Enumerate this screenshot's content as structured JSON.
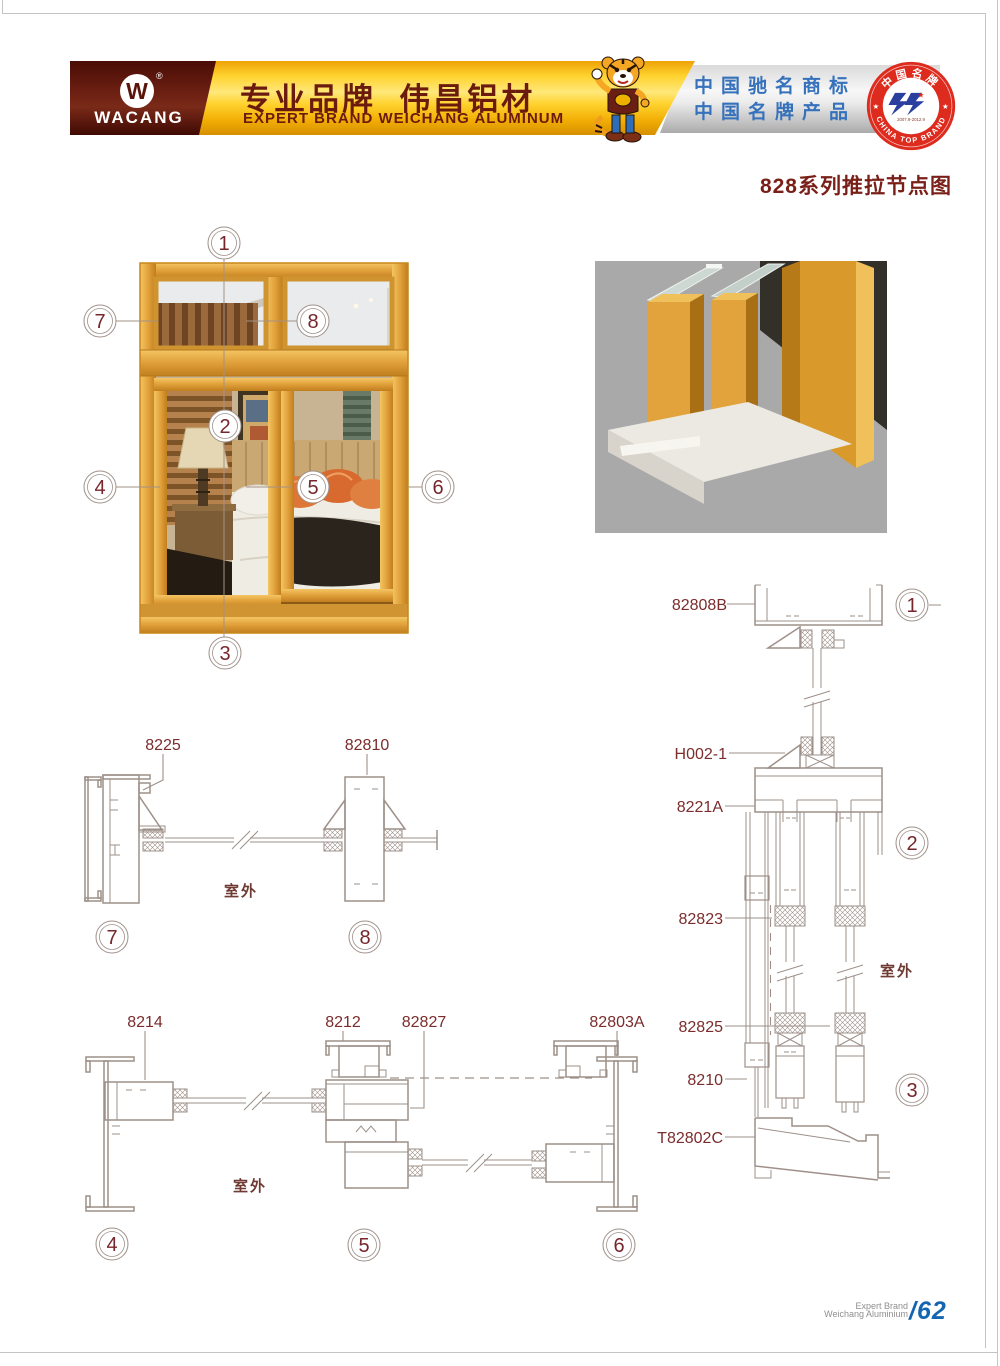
{
  "header": {
    "logo": {
      "brand": "WACANG",
      "registered": "®"
    },
    "slogan_cn": "专业品牌  伟昌铝材",
    "slogan_en": "EXPERT BRAND WEICHANG ALUMINUM",
    "awards": {
      "line1": "中国驰名商标",
      "line2": "中国名牌产品"
    },
    "seal": {
      "arc_top": "中国名牌",
      "arc_bottom": "CHINA TOP BRAND",
      "years": "2007.9-2012.9"
    }
  },
  "title": "828系列推拉节点图",
  "window_figure": {
    "callouts": {
      "c1": "1",
      "c2": "2",
      "c3": "3",
      "c4": "4",
      "c5": "5",
      "c6": "6",
      "c7": "7",
      "c8": "8"
    }
  },
  "details": {
    "outdoor_label": "室外",
    "top_section": {
      "labels": {
        "l8225": "8225",
        "l82810": "82810"
      },
      "callouts": {
        "c7": "7",
        "c8": "8"
      }
    },
    "bottom_section": {
      "labels": {
        "l8214": "8214",
        "l8212": "8212",
        "l82827": "82827",
        "l82803a": "82803A"
      },
      "callouts": {
        "c4": "4",
        "c5": "5",
        "c6": "6"
      }
    },
    "vertical_section": {
      "labels": {
        "l82808b": "82808B",
        "lh002": "H002-1",
        "l8221a": "8221A",
        "l82823": "82823",
        "l82825": "82825",
        "l8210": "8210",
        "lt82802c": "T82802C"
      },
      "callouts": {
        "c1": "1",
        "c2": "2",
        "c3": "3"
      }
    }
  },
  "footer": {
    "brand_line1": "Expert Brand",
    "brand_line2": "Weichang Aluminium",
    "page_number": "/62"
  },
  "colors": {
    "maroon_block": "#5a150b",
    "banner_yellow": "#ffd22e",
    "title_red": "#7a1f18",
    "drawing_line": "#9e9089",
    "callout_text": "#77262b",
    "award_blue": "#3672bc",
    "seal_red": "#dd2b1e",
    "footer_blue": "#1565b0",
    "frame_gold": "#e2a23c",
    "outdoor_text": "#6e3a33",
    "label_text": "#7b2c2c"
  }
}
